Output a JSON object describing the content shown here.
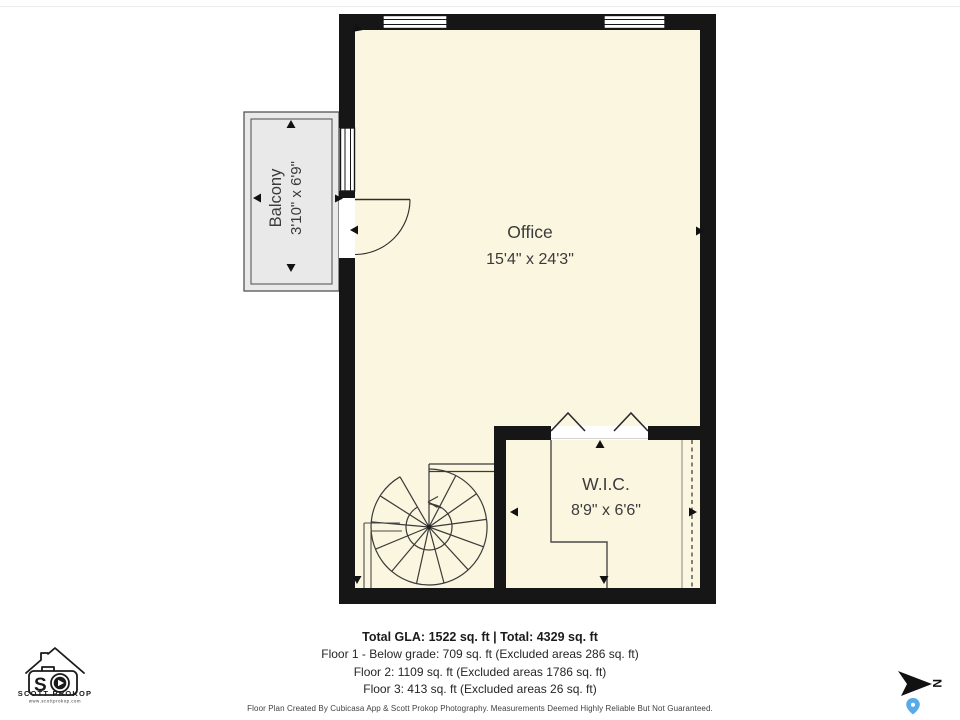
{
  "rooms": {
    "office": {
      "name": "Office",
      "dims": "15'4\" x 24'3\""
    },
    "wic": {
      "name": "W.I.C.",
      "dims": "8'9\" x 6'6\""
    },
    "balcony": {
      "name": "Balcony",
      "dims": "3'10\" x 6'9\""
    }
  },
  "summary": {
    "total": "Total GLA: 1522 sq. ft | Total: 4329 sq. ft",
    "floors": [
      "Floor 1 - Below grade: 709 sq. ft (Excluded areas 286 sq. ft)",
      "Floor 2: 1109 sq. ft (Excluded areas 1786 sq. ft)",
      "Floor 3: 413 sq. ft (Excluded areas 26 sq. ft)"
    ],
    "disclaimer": "Floor Plan Created By Cubicasa App & Scott Prokop Photography. Measurements Deemed Highly Reliable But Not Guaranteed."
  },
  "branding": {
    "monogram": "S",
    "name": "SCOTT PROKOP",
    "website": "www.scottprokop.com"
  },
  "compass": {
    "north_label": "N"
  },
  "colors": {
    "room_fill": "#FBF6DF",
    "wall": "#161616",
    "balcony_fill": "#E9E9E9",
    "pin_blue": "#57ABE9"
  }
}
